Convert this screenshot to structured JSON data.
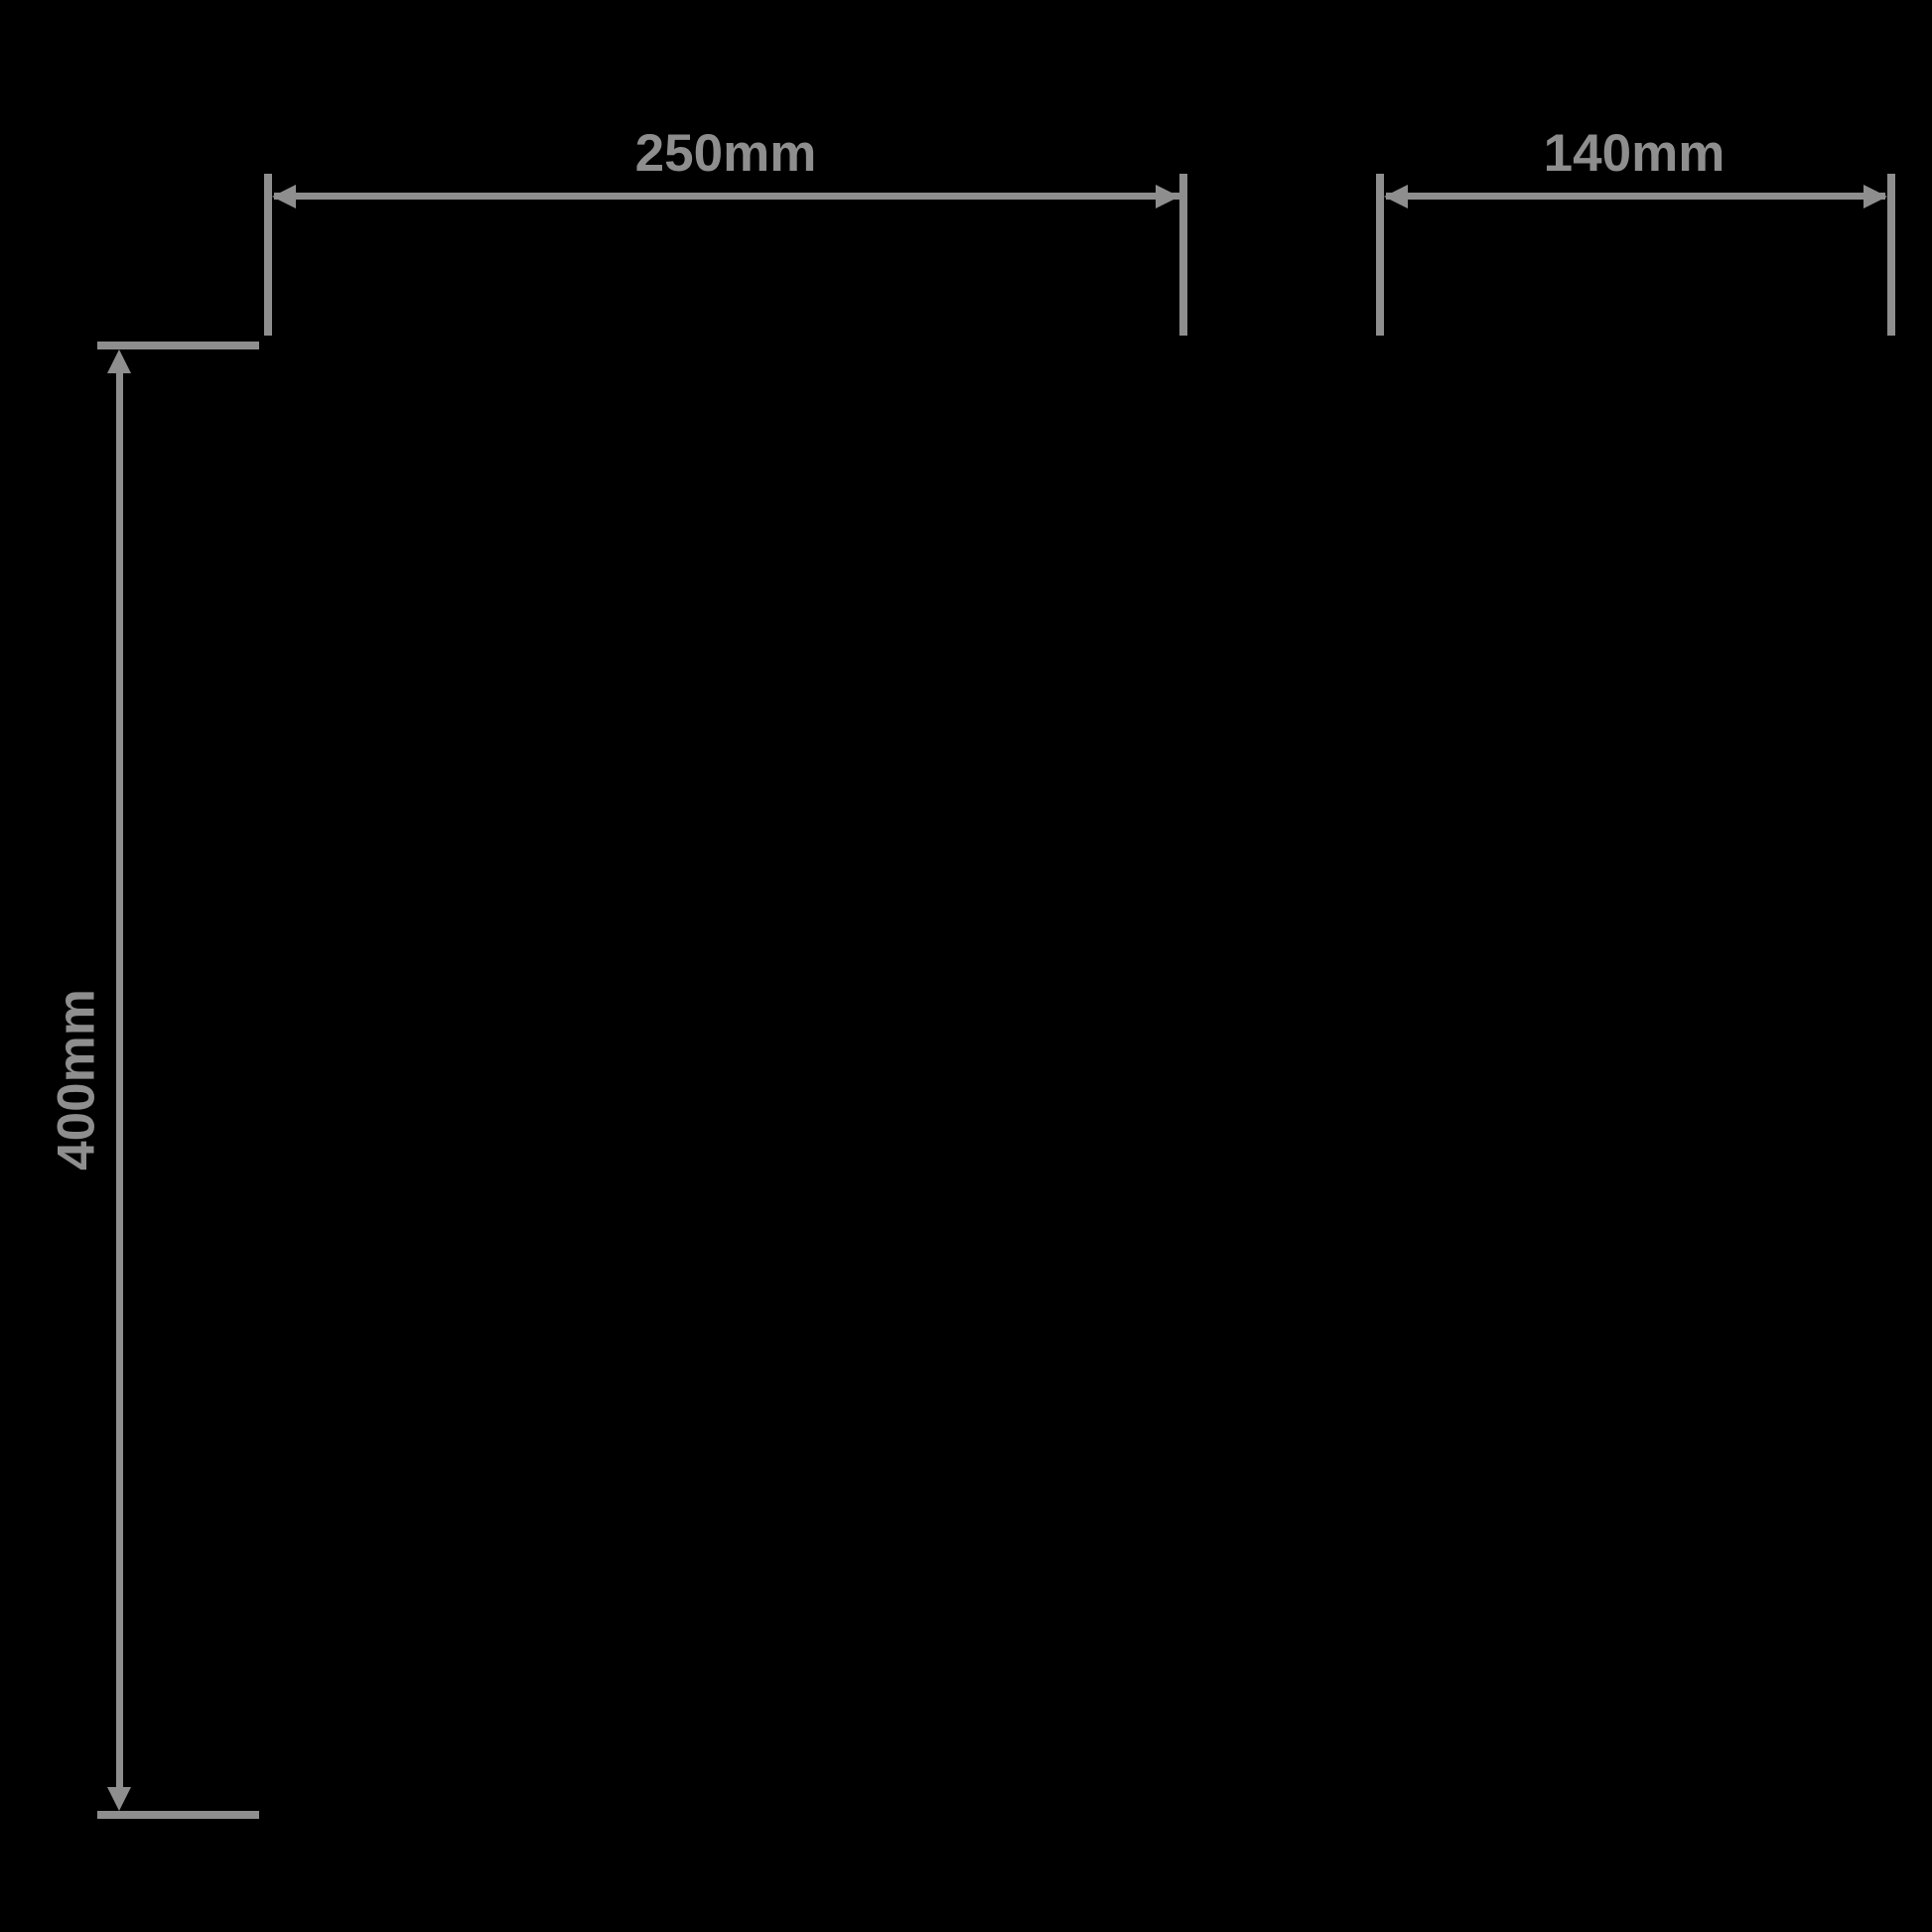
{
  "diagram": {
    "colors": {
      "background": "#000000",
      "line": "#8e8e8e",
      "text": "#8e8e8e"
    },
    "dimensions": {
      "width": {
        "label": "250mm",
        "orientation": "horizontal"
      },
      "depth": {
        "label": "140mm",
        "orientation": "horizontal"
      },
      "height": {
        "label": "400mm",
        "orientation": "vertical"
      }
    }
  }
}
